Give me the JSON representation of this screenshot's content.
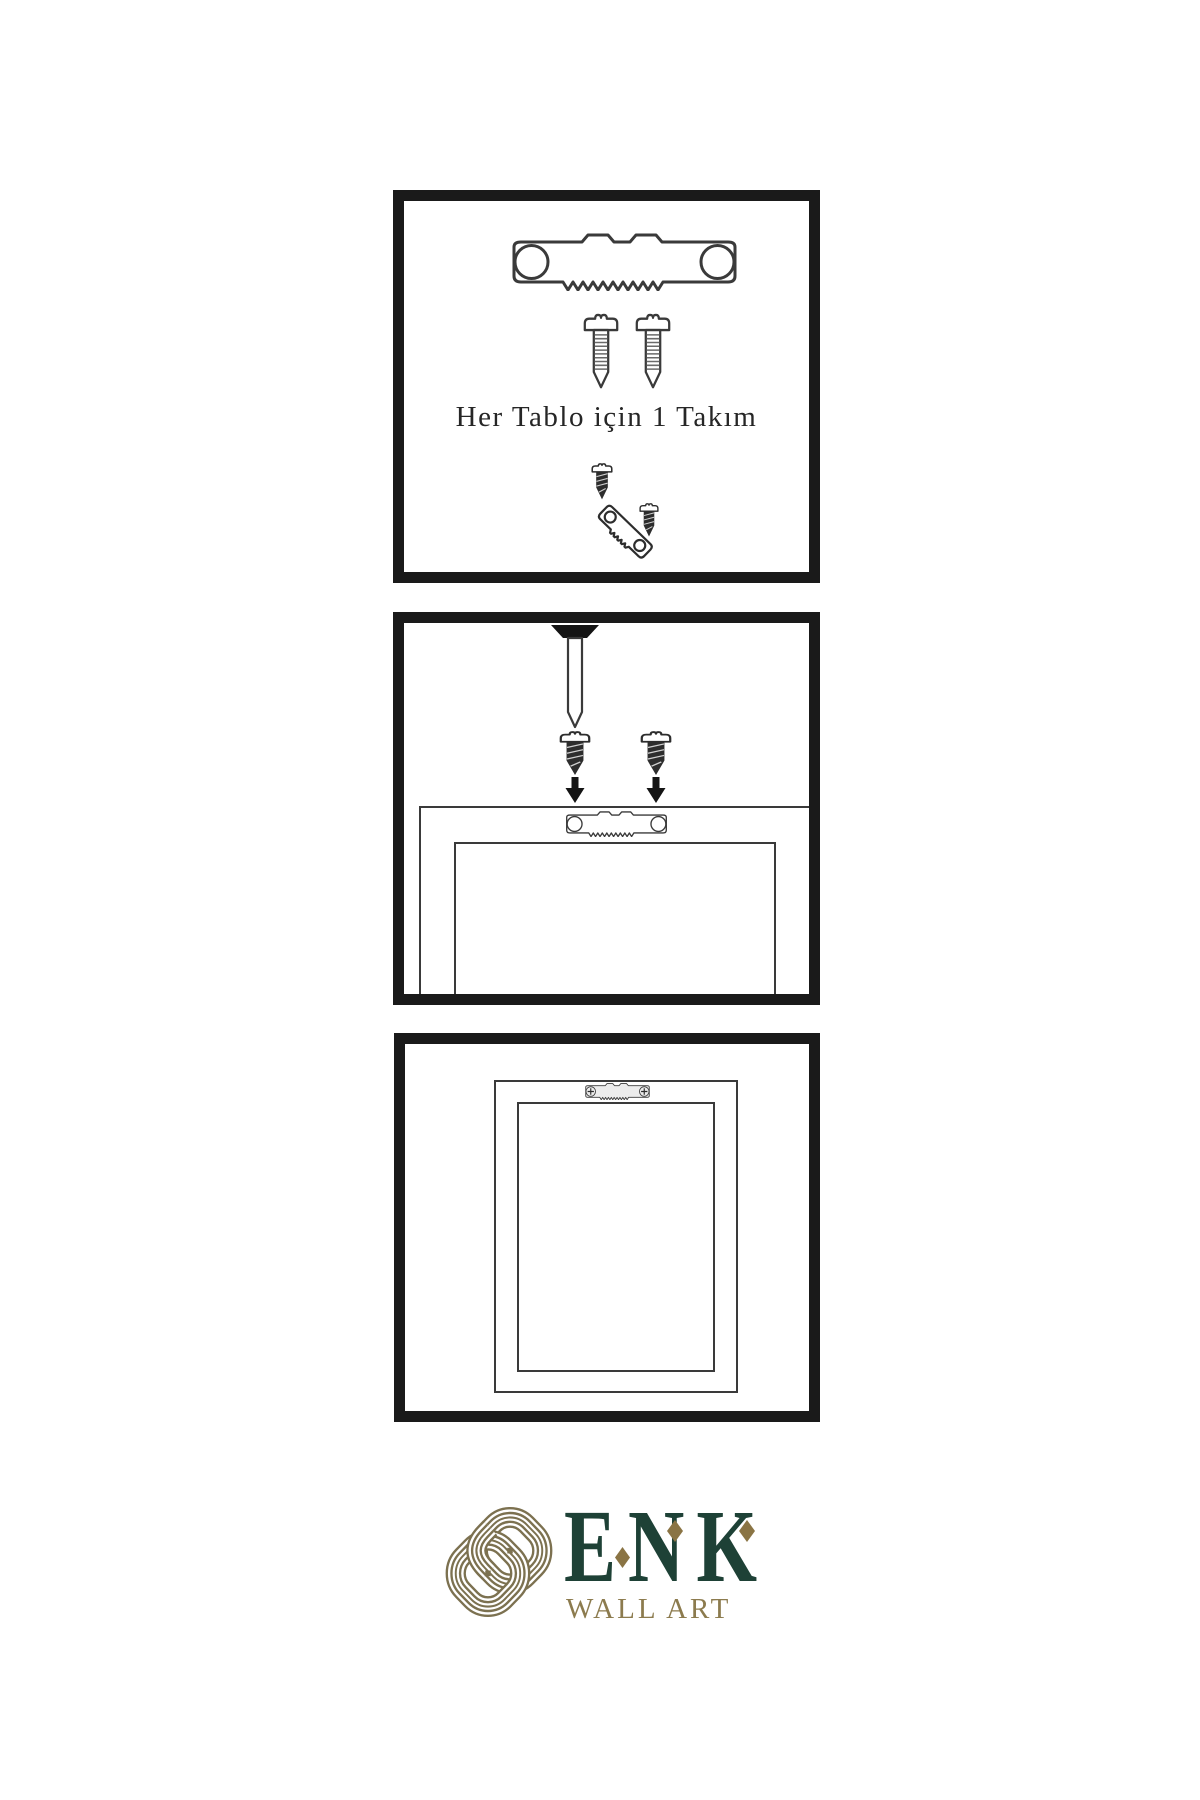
{
  "document": {
    "type": "wall-art-hanging-instruction-sheet",
    "background": "#ffffff"
  },
  "colors": {
    "panel_border": "#1a1a1a",
    "line_art": "#3a3a3a",
    "dark_metal": "#2d2d2d",
    "brand_green": "#1e4136",
    "brand_gold": "#8c7b4e",
    "knot_gold": "#7c7150",
    "diamond_gold": "#8a7444"
  },
  "steps": [
    {
      "caption": "Her Tablo için 1 Takım",
      "items": [
        "sawtooth-hanger-plate",
        "mounting-screw",
        "mounting-screw",
        "screw-and-angled-hanger"
      ]
    },
    {
      "items": [
        "wall-nail",
        "dark-screw",
        "dark-screw",
        "down-arrow",
        "down-arrow",
        "frame-back-with-sawtooth-hanger"
      ]
    },
    {
      "items": [
        "hung-frame-with-installed-hanger"
      ]
    }
  ],
  "brand": {
    "name": "ENK",
    "subtitle": "WALL ART"
  }
}
